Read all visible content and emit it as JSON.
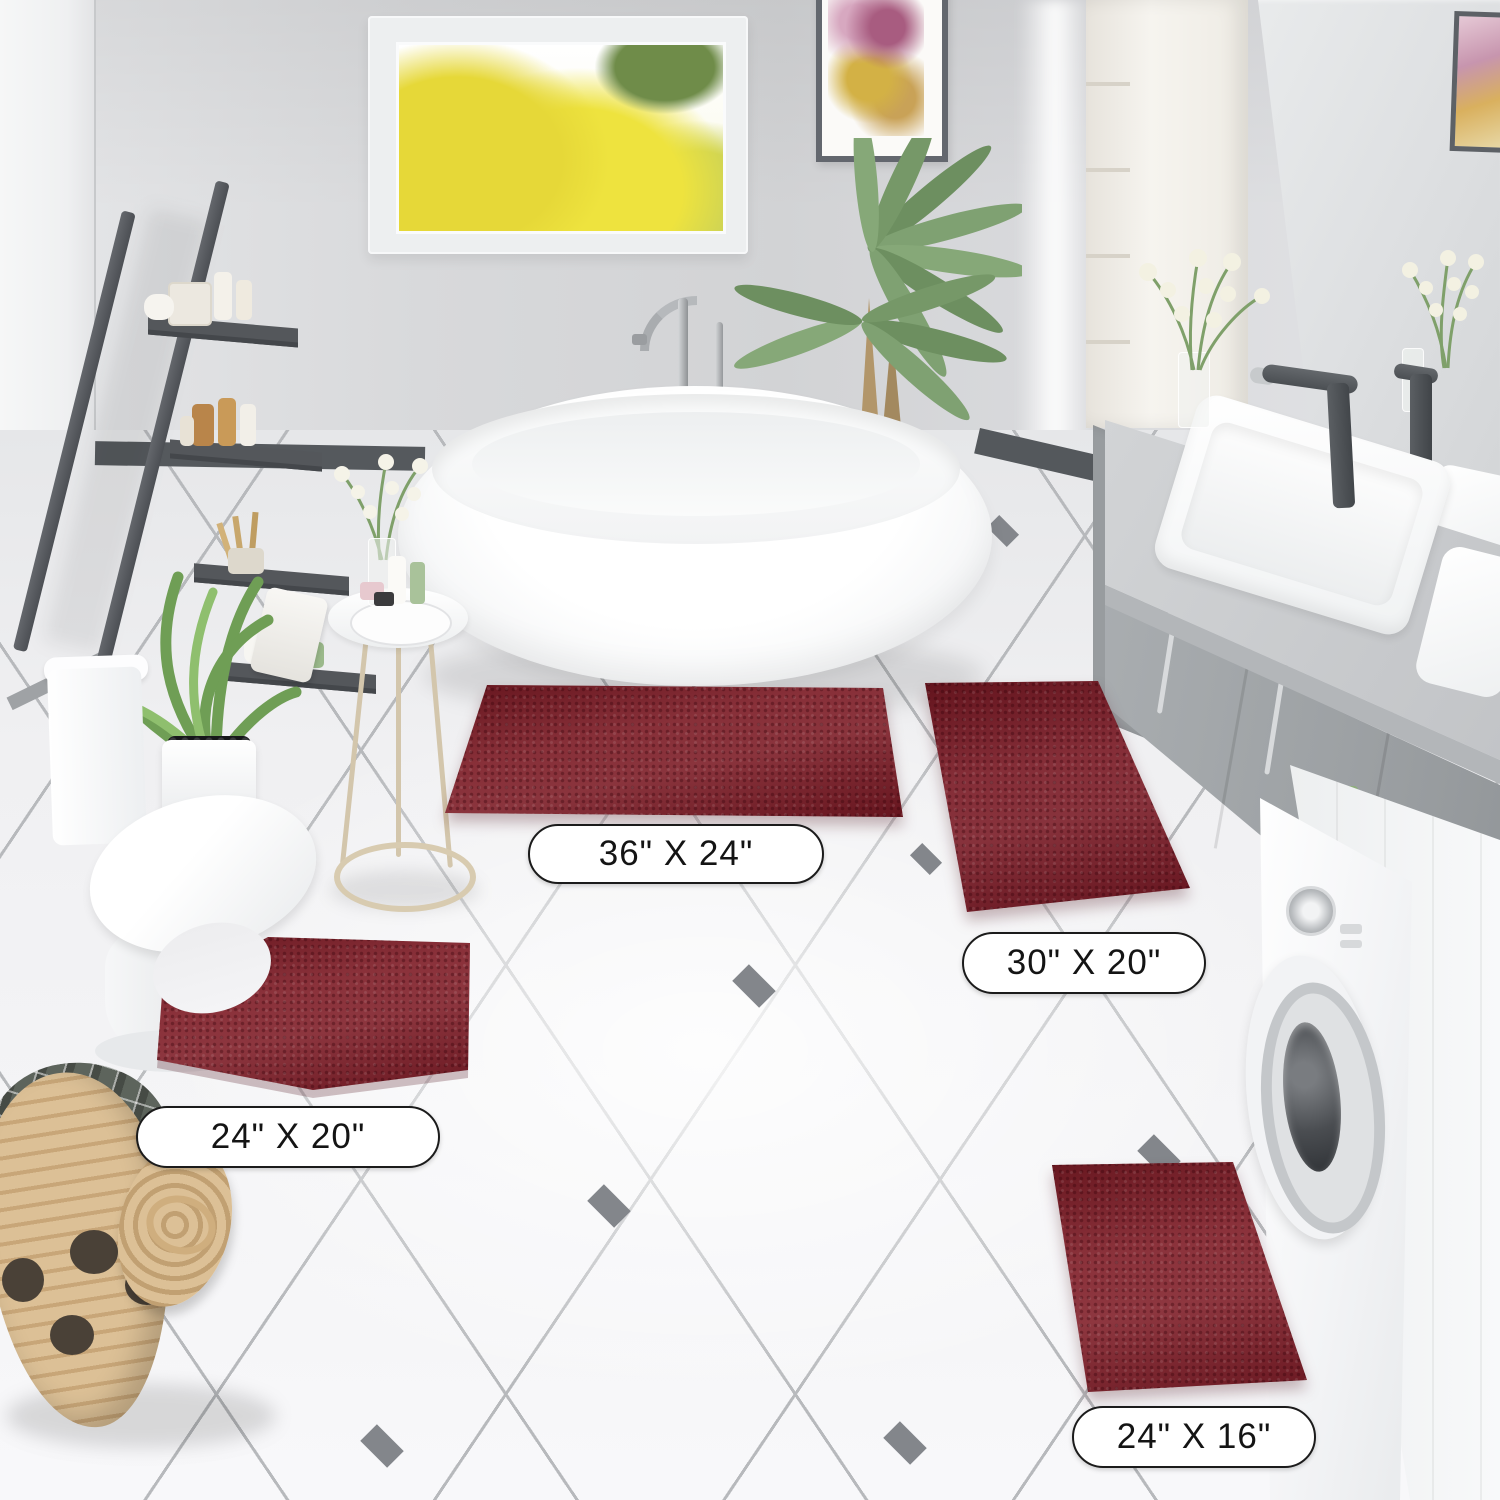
{
  "labels": {
    "rug_36x24": "36\" X 24\"",
    "rug_30x20": "30\" X 20\"",
    "rug_24x20": "24\" X 20\"",
    "rug_24x16": "24\" X 16\""
  },
  "colors": {
    "rug": "#7A1822",
    "rug_shadow": "#5E0F1B",
    "floor_tile": "#F2F2F4",
    "tile_accent": "#83868B",
    "wall": "#D8D9DB",
    "vanity_cabinet": "#A9ADB0",
    "ladder_shelf": "#54575B",
    "basket_wicker": "#DCC096",
    "label_bg": "#FFFFFF",
    "label_border": "#1B1B1B",
    "label_text": "#141414"
  }
}
